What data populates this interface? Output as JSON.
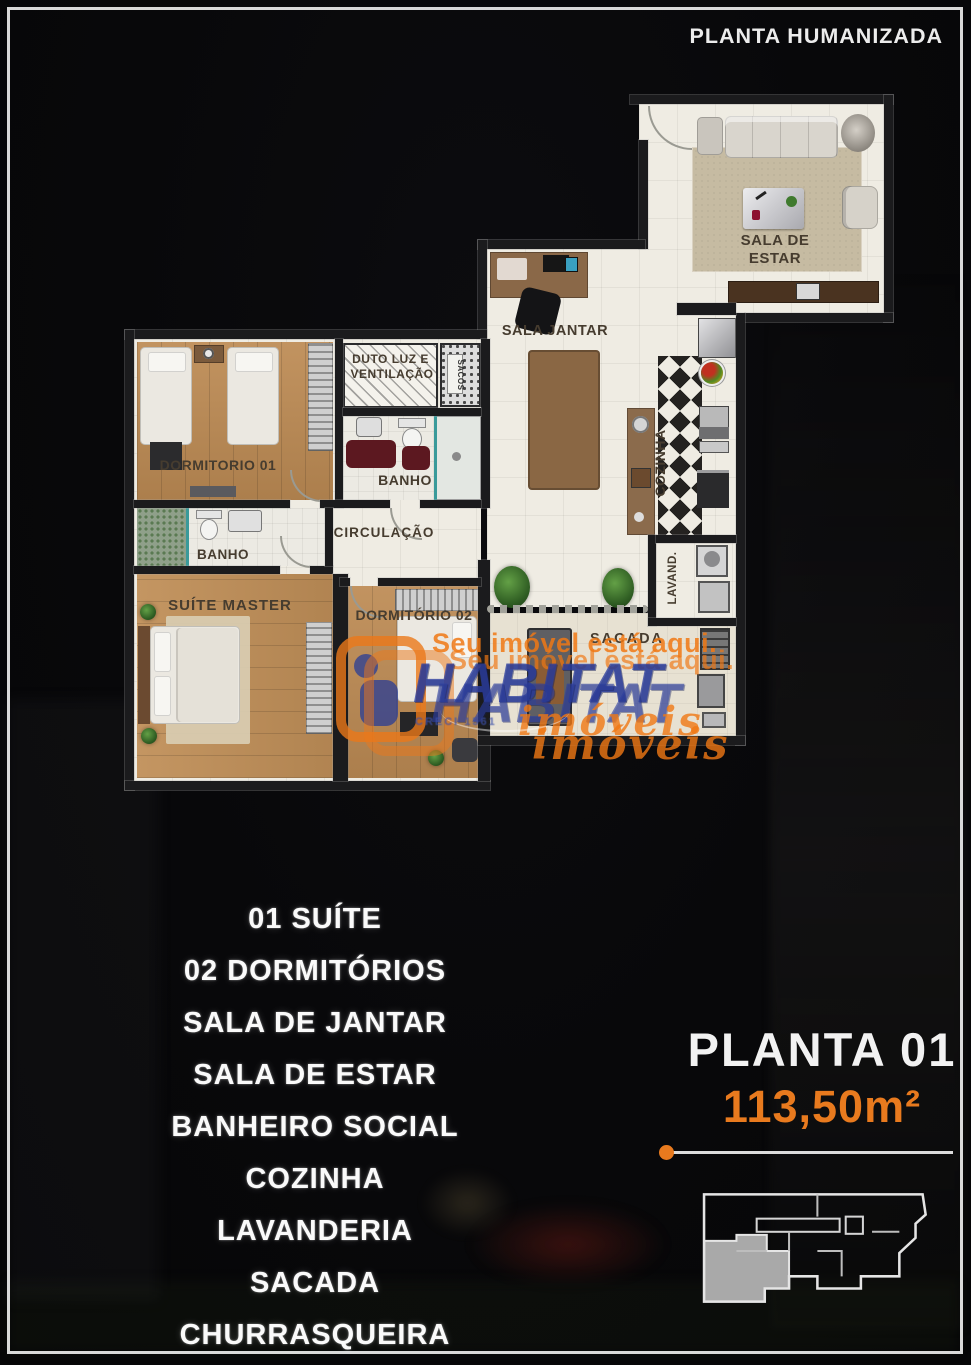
{
  "header": {
    "title": "PLANTA HUMANIZADA"
  },
  "plan": {
    "rooms": {
      "sala_estar": "SALA DE ESTAR",
      "sala_jantar": "SALA JANTAR",
      "cozinha": "COZINHA",
      "dormitorio_01": "DORMITORIO 01",
      "duto": "DUTO LUZ E VENTILAÇÃO",
      "sacos": "SACOS",
      "banho_social": "BANHO",
      "banho_suite": "BANHO",
      "circulacao": "CIRCULAÇÃO",
      "suite_master": "SUÍTE MASTER",
      "dormitorio_02": "DORMITÓRIO 02",
      "sacada": "SACADA",
      "lavanderia": "LAVAND."
    }
  },
  "features": [
    "01 SUÍTE",
    "02 DORMITÓRIOS",
    "SALA DE JANTAR",
    "SALA DE ESTAR",
    "BANHEIRO SOCIAL",
    "COZINHA",
    "LAVANDERIA",
    "SACADA",
    "CHURRASQUEIRA"
  ],
  "unit": {
    "name": "PLANTA 01",
    "area": "113,50m²"
  },
  "watermark": {
    "tagline": "Seu imóvel está aqui.",
    "brand": "HABITAT",
    "brand_type": "imóveis",
    "creci": "CRECI 1561"
  },
  "colors": {
    "accent_orange": "#e87a1e",
    "brand_blue": "#2b3f9e",
    "wall": "#1b1b1d"
  }
}
